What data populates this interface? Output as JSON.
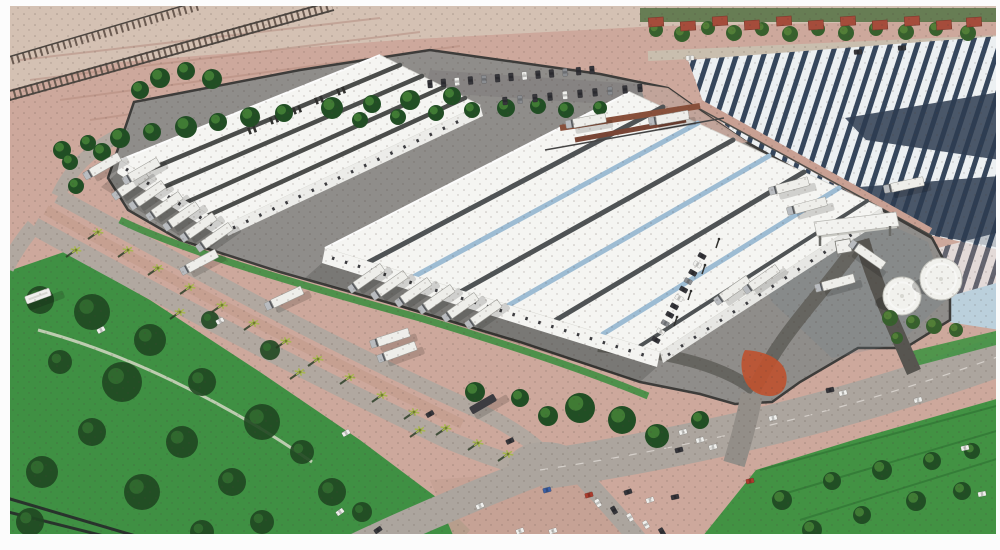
{
  "alt": "aerial architectural rendering of a logistics park with two white warehouses, truck docks, gatehouse, tanks and surrounding roads (no visible text)",
  "palette": {
    "paper": "#ffffff",
    "dirt": "#cfa99c",
    "dirtLight": "#d8c3b4",
    "pinkPatch": "#c9a79b",
    "median": "#c79e90",
    "boundary": "#caa093",
    "yard": "#8f8d8a",
    "yardDark": "#83817f",
    "roadLight": "#b2a9a0",
    "roadMid": "#ada69e",
    "roadDark": "#66645f",
    "gateRoad": "#56544f",
    "mouth": "#948e88",
    "wall": "#3c3b38",
    "grass": "#3f9340",
    "grassDark": "#2f7a33",
    "fieldTrack": "#ccd5bd",
    "greenStrip": "#3d8f3f",
    "greenBand": "#4a6b3a",
    "treeDark": "#1e4d21",
    "treeLite": "#3f7d33",
    "oliveDark": "#35602a",
    "oliveLite": "#527f35",
    "blob": "#1c461e",
    "roofWhite": "#f7f7f4",
    "wallWhite": "#f6f6f3",
    "wallShade": "#e9e9e6",
    "stripeDark": "#4e5254",
    "stripeBlue": "#9dbdd6",
    "navy": "#33455c",
    "navyPatch": "#2c3b50",
    "pond": "#bcd2de",
    "topRoad": "#cbbfae",
    "redRoof": "#a84a38",
    "orange": "#c2512c",
    "tank": "#f3f3ef",
    "truck": "#f0f0ec",
    "cab": "#b9bcc0",
    "darkVeh": "#3b3b40",
    "railTie": "#6b5a50",
    "rail": "#4a443e",
    "rust": "#8a4f39",
    "rust2": "#7a4433"
  },
  "buildings": {
    "warehouse1_roof_stripe_colors": [
      "#4a4c4a",
      "#4a4c4a",
      "#4a4c4a",
      "#4a4c4a"
    ],
    "warehouse2_roof_stripe_colors": [
      "#4e5254",
      "#9dbdd6",
      "#4e5254",
      "#9dbdd6",
      "#4e5254",
      "#9dbdd6",
      "#4e5254"
    ]
  },
  "vehicle_colors": {
    "w": "#f2f2ef",
    "d": "#34343a",
    "r": "#b03a2a",
    "b": "#3a5fa8",
    "g": "#8a8d92"
  },
  "trucks": [
    {
      "x": 131,
      "y": 185,
      "a": -35,
      "t": "trailer"
    },
    {
      "x": 148,
      "y": 195,
      "a": -35,
      "t": "trailer"
    },
    {
      "x": 165,
      "y": 206,
      "a": -35,
      "t": "trailer"
    },
    {
      "x": 182,
      "y": 216,
      "a": -35,
      "t": "trailer"
    },
    {
      "x": 199,
      "y": 227,
      "a": -35,
      "t": "trailer"
    },
    {
      "x": 215,
      "y": 237,
      "a": -35,
      "t": "trailer"
    },
    {
      "x": 367,
      "y": 278,
      "a": -35,
      "t": "trailer"
    },
    {
      "x": 390,
      "y": 285,
      "a": -35,
      "t": "trailer"
    },
    {
      "x": 414,
      "y": 292,
      "a": -35,
      "t": "trailer"
    },
    {
      "x": 437,
      "y": 299,
      "a": -35,
      "t": "trailer"
    },
    {
      "x": 461,
      "y": 307,
      "a": -35,
      "t": "trailer"
    },
    {
      "x": 484,
      "y": 314,
      "a": -35,
      "t": "trailer"
    },
    {
      "x": 103,
      "y": 166,
      "a": -30,
      "t": "trailer"
    },
    {
      "x": 142,
      "y": 171,
      "a": -30,
      "t": "trailer"
    },
    {
      "x": 200,
      "y": 262,
      "a": -28,
      "t": "trailer"
    },
    {
      "x": 285,
      "y": 298,
      "a": -25,
      "t": "trailer"
    },
    {
      "x": 391,
      "y": 338,
      "a": -18,
      "t": "trailer"
    },
    {
      "x": 398,
      "y": 352,
      "a": -20,
      "t": "trailer"
    },
    {
      "x": 587,
      "y": 121,
      "a": -10,
      "t": "trailer"
    },
    {
      "x": 670,
      "y": 118,
      "a": -10,
      "t": "trailer"
    },
    {
      "x": 733,
      "y": 290,
      "a": -35,
      "t": "trailer"
    },
    {
      "x": 762,
      "y": 279,
      "a": -35,
      "t": "trailer"
    },
    {
      "x": 790,
      "y": 186,
      "a": -15,
      "t": "trailer"
    },
    {
      "x": 808,
      "y": 206,
      "a": -15,
      "t": "trailer"
    },
    {
      "x": 836,
      "y": 283,
      "a": -15,
      "t": "trailer"
    },
    {
      "x": 868,
      "y": 255,
      "a": 35,
      "t": "trailer"
    },
    {
      "x": 905,
      "y": 185,
      "a": -12,
      "t": "trailer"
    },
    {
      "x": 38,
      "y": 296,
      "a": -20,
      "t": "bus"
    },
    {
      "x": 483,
      "y": 404,
      "a": -30,
      "t": "dark"
    }
  ],
  "cars": [
    {
      "x": 683,
      "y": 432,
      "a": -14,
      "c": "w"
    },
    {
      "x": 700,
      "y": 440,
      "a": -14,
      "c": "w"
    },
    {
      "x": 713,
      "y": 447,
      "a": -14,
      "c": "w"
    },
    {
      "x": 679,
      "y": 450,
      "a": -14,
      "c": "d"
    },
    {
      "x": 773,
      "y": 418,
      "a": -13,
      "c": "w"
    },
    {
      "x": 830,
      "y": 390,
      "a": -13,
      "c": "d"
    },
    {
      "x": 843,
      "y": 393,
      "a": -13,
      "c": "w"
    },
    {
      "x": 918,
      "y": 400,
      "a": -12,
      "c": "w"
    },
    {
      "x": 965,
      "y": 448,
      "a": -12,
      "c": "w"
    },
    {
      "x": 982,
      "y": 494,
      "a": -10,
      "c": "w"
    },
    {
      "x": 750,
      "y": 481,
      "a": -12,
      "c": "r"
    },
    {
      "x": 675,
      "y": 497,
      "a": -12,
      "c": "d"
    },
    {
      "x": 547,
      "y": 490,
      "a": -15,
      "c": "b"
    },
    {
      "x": 589,
      "y": 495,
      "a": -15,
      "c": "r"
    },
    {
      "x": 430,
      "y": 414,
      "a": -30,
      "c": "d"
    },
    {
      "x": 510,
      "y": 441,
      "a": -25,
      "c": "d"
    },
    {
      "x": 520,
      "y": 531,
      "a": -20,
      "c": "w"
    },
    {
      "x": 553,
      "y": 531,
      "a": -18,
      "c": "w"
    },
    {
      "x": 480,
      "y": 506,
      "a": -25,
      "c": "w"
    },
    {
      "x": 346,
      "y": 433,
      "a": -30,
      "c": "w"
    },
    {
      "x": 101,
      "y": 330,
      "a": -28,
      "c": "w"
    },
    {
      "x": 220,
      "y": 321,
      "a": -28,
      "c": "w"
    },
    {
      "x": 858,
      "y": 52,
      "a": -3,
      "c": "d"
    },
    {
      "x": 902,
      "y": 48,
      "a": -3,
      "c": "d"
    },
    {
      "x": 690,
      "y": 58,
      "a": -3,
      "c": "w"
    },
    {
      "x": 628,
      "y": 492,
      "a": -18,
      "c": "d"
    },
    {
      "x": 650,
      "y": 500,
      "a": -18,
      "c": "w"
    },
    {
      "x": 340,
      "y": 512,
      "a": -35,
      "c": "w"
    },
    {
      "x": 378,
      "y": 530,
      "a": -35,
      "c": "d"
    }
  ],
  "car_rows": [
    {
      "x1": 430,
      "y1": 84,
      "x2": 592,
      "y2": 70,
      "count": 13,
      "carAngle": 85,
      "colors": [
        "d",
        "d",
        "w",
        "d",
        "g",
        "d",
        "d",
        "w",
        "d",
        "d",
        "g",
        "d",
        "d"
      ]
    },
    {
      "x1": 505,
      "y1": 101,
      "x2": 640,
      "y2": 88,
      "count": 10,
      "carAngle": 85,
      "colors": [
        "d",
        "g",
        "d",
        "d",
        "w",
        "d",
        "d",
        "g",
        "d",
        "d"
      ]
    },
    {
      "x1": 702,
      "y1": 256,
      "x2": 656,
      "y2": 340,
      "count": 11,
      "carAngle": 29,
      "colors": [
        "d",
        "w",
        "d",
        "g",
        "d",
        "w",
        "d",
        "d",
        "g",
        "w",
        "d"
      ]
    },
    {
      "x1": 598,
      "y1": 503,
      "x2": 678,
      "y2": 539,
      "count": 6,
      "carAngle": 60,
      "colors": [
        "w",
        "d",
        "w",
        "w",
        "d",
        "w"
      ]
    }
  ],
  "trees": [
    [
      62,
      150,
      9
    ],
    [
      88,
      143,
      8
    ],
    [
      120,
      138,
      10
    ],
    [
      152,
      132,
      9
    ],
    [
      186,
      127,
      11
    ],
    [
      218,
      122,
      9
    ],
    [
      250,
      117,
      10
    ],
    [
      284,
      113,
      9
    ],
    [
      332,
      108,
      11
    ],
    [
      372,
      104,
      9
    ],
    [
      410,
      100,
      10
    ],
    [
      452,
      96,
      9
    ],
    [
      360,
      120,
      8
    ],
    [
      398,
      117,
      8
    ],
    [
      436,
      113,
      8
    ],
    [
      472,
      110,
      8
    ],
    [
      506,
      108,
      9
    ],
    [
      538,
      106,
      8
    ],
    [
      566,
      110,
      8
    ],
    [
      600,
      108,
      7
    ],
    [
      160,
      78,
      10
    ],
    [
      186,
      71,
      9
    ],
    [
      212,
      79,
      10
    ],
    [
      140,
      90,
      9
    ],
    [
      70,
      162,
      8
    ],
    [
      102,
      152,
      9
    ],
    [
      76,
      186,
      8
    ],
    [
      656,
      30,
      7,
      "o"
    ],
    [
      682,
      34,
      8,
      "o"
    ],
    [
      708,
      28,
      7,
      "o"
    ],
    [
      734,
      33,
      8,
      "o"
    ],
    [
      762,
      29,
      7,
      "o"
    ],
    [
      790,
      34,
      8,
      "o"
    ],
    [
      818,
      29,
      7,
      "o"
    ],
    [
      846,
      33,
      8,
      "o"
    ],
    [
      876,
      29,
      7,
      "o"
    ],
    [
      906,
      32,
      8,
      "o"
    ],
    [
      936,
      29,
      7,
      "o"
    ],
    [
      968,
      33,
      8,
      "o"
    ],
    [
      475,
      392,
      10
    ],
    [
      520,
      398,
      9
    ],
    [
      580,
      408,
      15
    ],
    [
      622,
      420,
      14
    ],
    [
      657,
      436,
      12
    ],
    [
      548,
      416,
      10
    ],
    [
      700,
      420,
      9
    ],
    [
      890,
      318,
      8,
      "o"
    ],
    [
      913,
      322,
      7,
      "o"
    ],
    [
      934,
      326,
      8,
      "o"
    ],
    [
      956,
      330,
      7,
      "o"
    ],
    [
      897,
      338,
      6,
      "o"
    ],
    [
      782,
      500,
      10
    ],
    [
      832,
      481,
      9
    ],
    [
      882,
      470,
      10
    ],
    [
      932,
      461,
      9
    ],
    [
      972,
      451,
      8
    ],
    [
      812,
      530,
      10
    ],
    [
      862,
      515,
      9
    ],
    [
      916,
      501,
      10
    ],
    [
      962,
      491,
      9
    ]
  ],
  "field_blobs": [
    [
      40,
      300,
      14
    ],
    [
      92,
      312,
      18
    ],
    [
      150,
      340,
      16
    ],
    [
      60,
      362,
      12
    ],
    [
      122,
      382,
      20
    ],
    [
      202,
      382,
      14
    ],
    [
      262,
      422,
      18
    ],
    [
      182,
      442,
      16
    ],
    [
      92,
      432,
      14
    ],
    [
      42,
      472,
      16
    ],
    [
      142,
      492,
      18
    ],
    [
      232,
      482,
      14
    ],
    [
      302,
      452,
      12
    ],
    [
      332,
      492,
      14
    ],
    [
      262,
      522,
      12
    ],
    [
      362,
      512,
      10
    ],
    [
      30,
      522,
      14
    ],
    [
      202,
      532,
      12
    ],
    [
      270,
      350,
      10
    ],
    [
      210,
      320,
      9
    ]
  ],
  "palms": [
    [
      98,
      232
    ],
    [
      128,
      250
    ],
    [
      158,
      268
    ],
    [
      190,
      287
    ],
    [
      222,
      305
    ],
    [
      254,
      323
    ],
    [
      286,
      341
    ],
    [
      318,
      359
    ],
    [
      350,
      377
    ],
    [
      382,
      395
    ],
    [
      414,
      412
    ],
    [
      446,
      428
    ],
    [
      478,
      443
    ],
    [
      508,
      454
    ],
    [
      76,
      250
    ],
    [
      180,
      312
    ],
    [
      300,
      372
    ],
    [
      420,
      430
    ]
  ],
  "houses": [
    [
      656,
      22
    ],
    [
      688,
      26
    ],
    [
      720,
      21
    ],
    [
      752,
      25
    ],
    [
      784,
      21
    ],
    [
      816,
      25
    ],
    [
      848,
      21
    ],
    [
      880,
      25
    ],
    [
      912,
      21
    ],
    [
      944,
      25
    ],
    [
      974,
      22
    ]
  ],
  "roof_vents": [
    [
      252,
      130
    ],
    [
      274,
      120
    ],
    [
      297,
      110
    ],
    [
      319,
      100
    ],
    [
      341,
      91
    ]
  ],
  "light_poles": [
    [
      716,
      248
    ],
    [
      702,
      274
    ],
    [
      688,
      300
    ],
    [
      674,
      326
    ]
  ],
  "tanks": [
    {
      "x": 902,
      "y": 296,
      "r": 19
    },
    {
      "x": 941,
      "y": 279,
      "r": 21
    }
  ]
}
